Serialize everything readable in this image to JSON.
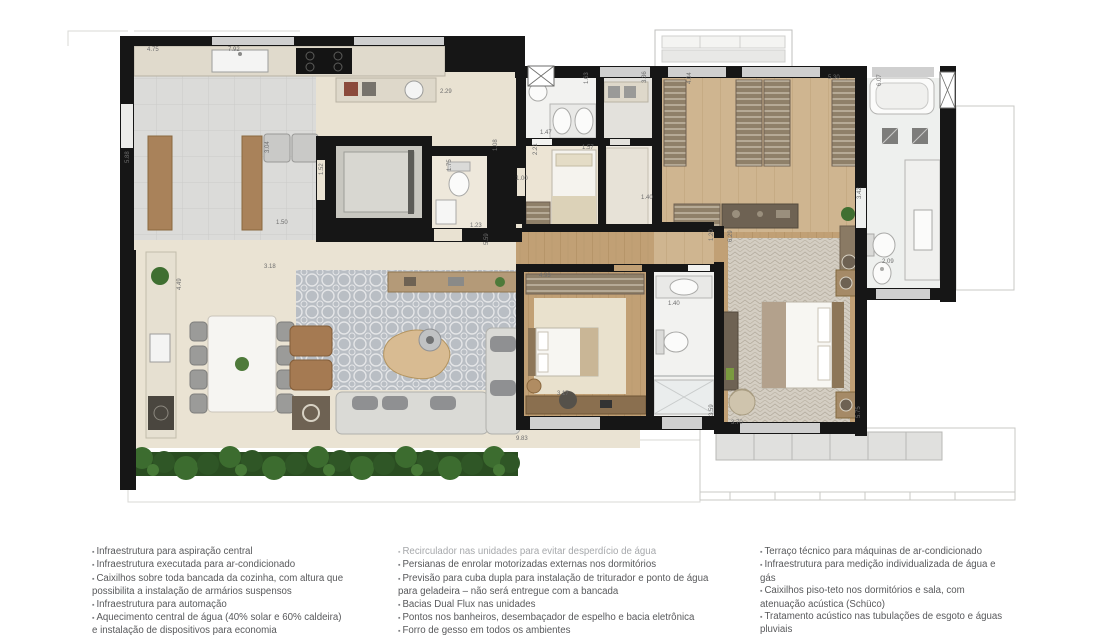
{
  "floor_plan": {
    "colors": {
      "wall": "#161616",
      "kitchen_tile": "#dbdbd9",
      "terrace_floor": "#e9e2d2",
      "wood_floor": "#c1a075",
      "closet_wood": "#cfb590",
      "bathroom": "#f0f1ef",
      "rug_gray": "#bcc1c7",
      "rug_cream": "#e9e1cd",
      "rug_herringbone": "#d3cdc2",
      "hedge_green": "#3c6c2f",
      "sofa_gray": "#dadad6",
      "furniture_wood": "#a9825a"
    },
    "dimension_labels": [
      {
        "t": "4.75",
        "x": 147,
        "y": 51
      },
      {
        "t": "7.92",
        "x": 228,
        "y": 51
      },
      {
        "t": "5.88",
        "x": 129,
        "y": 163,
        "v": 1
      },
      {
        "t": "2.29",
        "x": 440,
        "y": 93
      },
      {
        "t": "3.04",
        "x": 269,
        "y": 153,
        "v": 1
      },
      {
        "t": "1.52",
        "x": 323,
        "y": 175,
        "v": 1
      },
      {
        "t": "1.50",
        "x": 276,
        "y": 224
      },
      {
        "t": "3.18",
        "x": 264,
        "y": 268
      },
      {
        "t": "4.49",
        "x": 181,
        "y": 290,
        "v": 1
      },
      {
        "t": "1.75",
        "x": 451,
        "y": 171,
        "v": 1
      },
      {
        "t": "1.23",
        "x": 470,
        "y": 227
      },
      {
        "t": "5.59",
        "x": 488,
        "y": 245,
        "v": 1
      },
      {
        "t": "1.08",
        "x": 497,
        "y": 151,
        "v": 1
      },
      {
        "t": "1.00",
        "x": 516,
        "y": 180
      },
      {
        "t": "1.63",
        "x": 588,
        "y": 84,
        "v": 1
      },
      {
        "t": "1.47",
        "x": 540,
        "y": 134
      },
      {
        "t": "2.21",
        "x": 537,
        "y": 155,
        "v": 1
      },
      {
        "t": "1.57",
        "x": 582,
        "y": 149
      },
      {
        "t": "3.36",
        "x": 646,
        "y": 83,
        "v": 1
      },
      {
        "t": "1.40",
        "x": 641,
        "y": 199
      },
      {
        "t": "4.04",
        "x": 691,
        "y": 84,
        "v": 1
      },
      {
        "t": "5.30",
        "x": 828,
        "y": 79
      },
      {
        "t": "6.07",
        "x": 881,
        "y": 86,
        "v": 1
      },
      {
        "t": "3.42",
        "x": 861,
        "y": 199,
        "v": 1
      },
      {
        "t": "2.09",
        "x": 882,
        "y": 263
      },
      {
        "t": "1.20",
        "x": 713,
        "y": 241,
        "v": 1
      },
      {
        "t": "6.29",
        "x": 732,
        "y": 242,
        "v": 1
      },
      {
        "t": "4.93",
        "x": 539,
        "y": 277
      },
      {
        "t": "3.17",
        "x": 557,
        "y": 395
      },
      {
        "t": "1.40",
        "x": 668,
        "y": 305
      },
      {
        "t": "3.59",
        "x": 713,
        "y": 416,
        "v": 1
      },
      {
        "t": "3.70",
        "x": 731,
        "y": 424
      },
      {
        "t": "5.75",
        "x": 860,
        "y": 418,
        "v": 1
      },
      {
        "t": "9.83",
        "x": 516,
        "y": 440
      }
    ]
  },
  "features": {
    "columns": [
      {
        "left": 92,
        "width": 252,
        "items": [
          {
            "text": "Infraestrutura para aspiração central"
          },
          {
            "text": "Infraestrutura executada para ar-condicionado"
          },
          {
            "text": "Caixilhos sobre toda bancada da cozinha, com altura que possibilita a instalação de armários suspensos"
          },
          {
            "text": "Infraestrutura para automação"
          },
          {
            "text": "Aquecimento central de água (40% solar e 60% caldeira) e instalação de dispositivos para economia"
          }
        ]
      },
      {
        "left": 398,
        "width": 318,
        "items": [
          {
            "text": "Recirculador nas unidades para evitar desperdício de água",
            "muted": true
          },
          {
            "text": "Persianas de enrolar motorizadas externas nos dormitórios"
          },
          {
            "text": "Previsão para cuba dupla para instalação de triturador e ponto de água para geladeira – não será entregue com a bancada"
          },
          {
            "text": "Bacias Dual Flux nas unidades"
          },
          {
            "text": "Pontos nos banheiros, desembaçador de espelho e bacia eletrônica"
          },
          {
            "text": "Forro de gesso em todos os ambientes"
          }
        ]
      },
      {
        "left": 760,
        "width": 244,
        "items": [
          {
            "text": "Terraço técnico para máquinas de ar-condicionado"
          },
          {
            "text": "Infraestrutura para medição individualizada de água e gás"
          },
          {
            "text": "Caixilhos piso-teto nos dormitórios e sala, com atenuação acústica (Schüco)"
          },
          {
            "text": "Tratamento acústico nas tubulações de esgoto e águas pluviais"
          }
        ]
      }
    ]
  }
}
